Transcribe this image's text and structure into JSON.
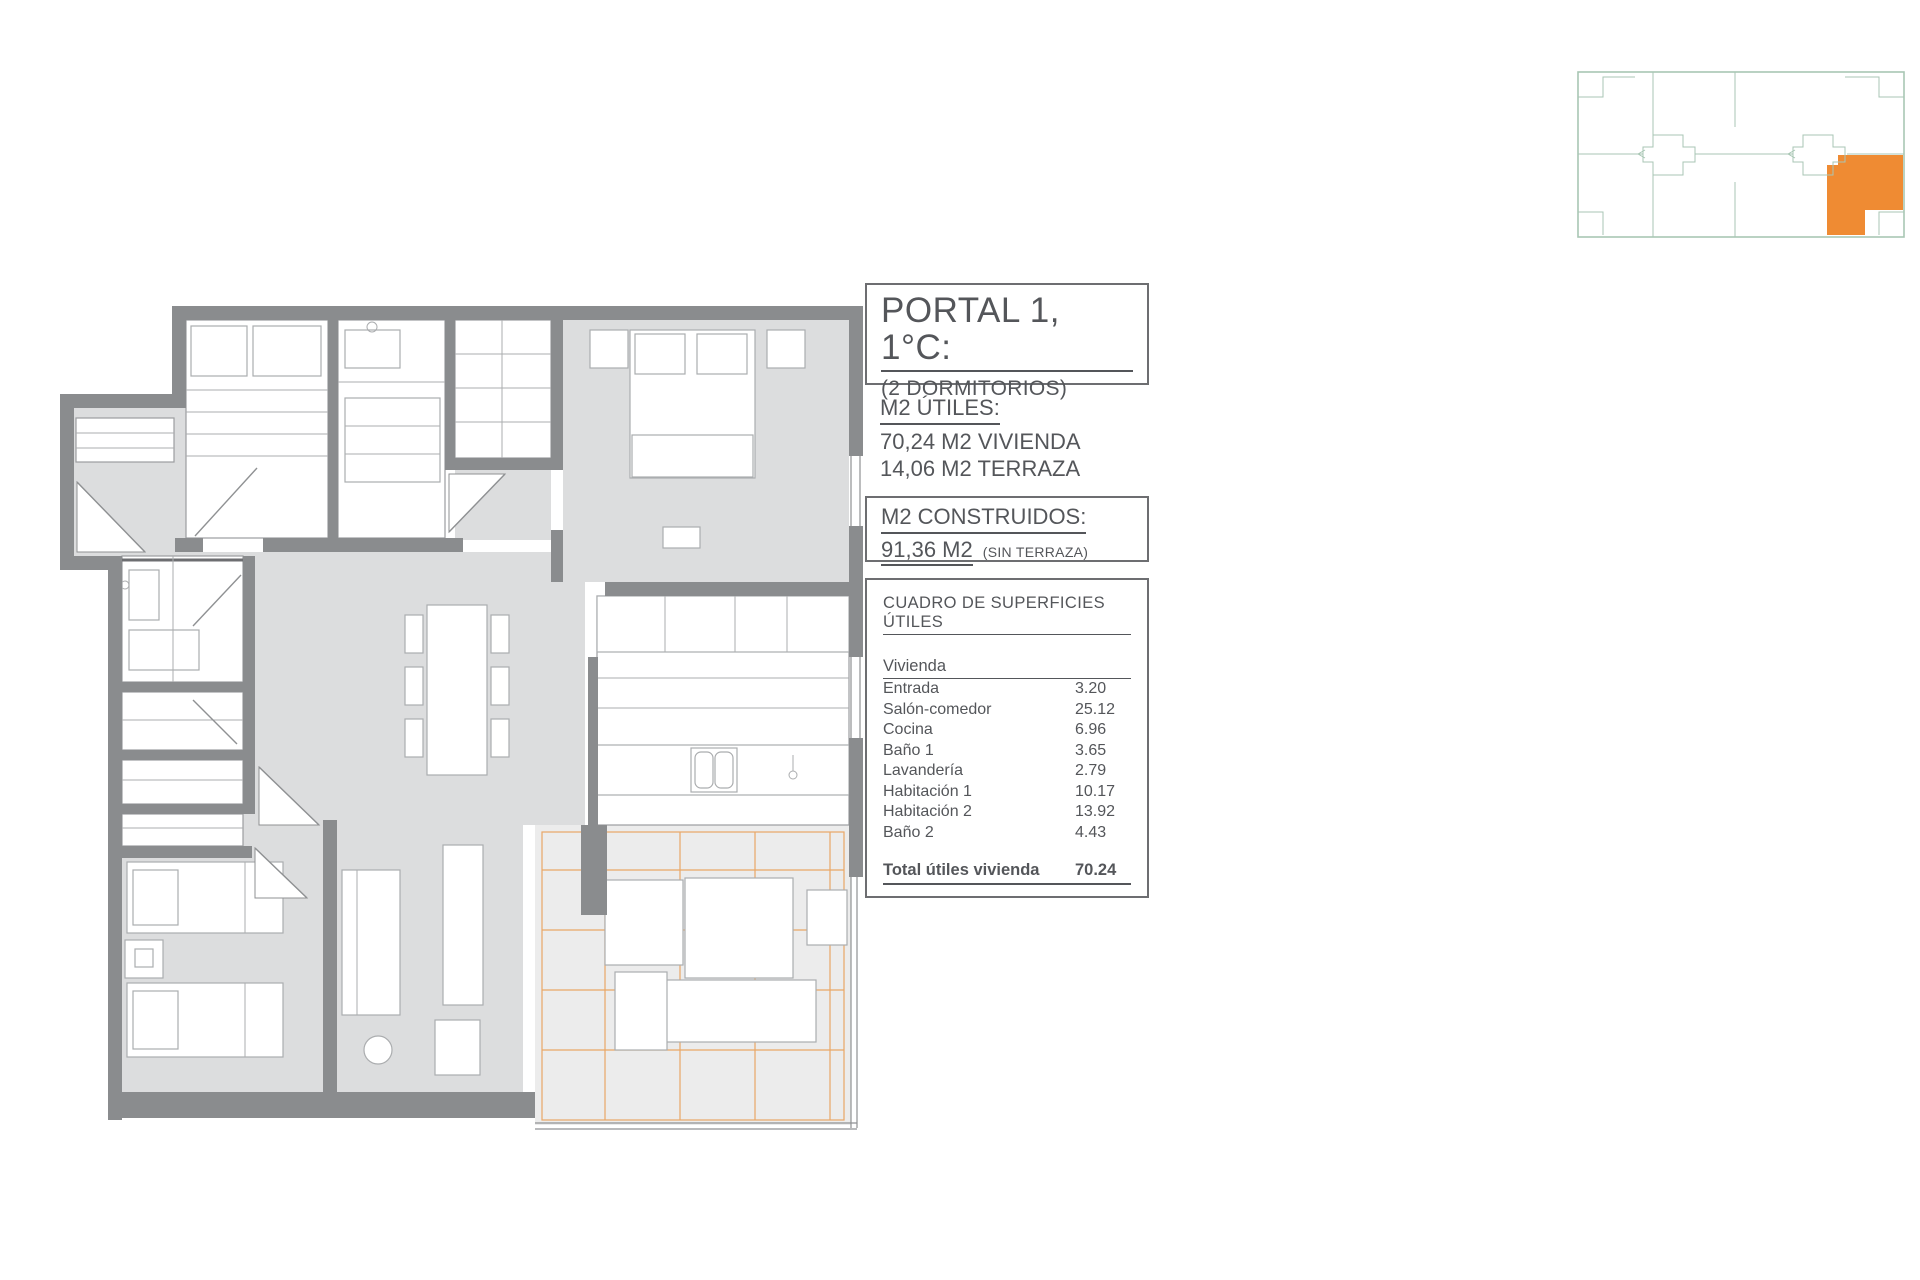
{
  "title_block": {
    "title": "PORTAL 1, 1°C:",
    "subtitle": "(2 DORMITORIOS)"
  },
  "m2_utiles": {
    "heading": "M2 ÚTILES:",
    "line1": "70,24 M2 VIVIENDA",
    "line2": "14,06 M2 TERRAZA"
  },
  "m2_construidos": {
    "heading": "M2 CONSTRUIDOS:",
    "value": "91,36 M2",
    "note": "(SIN TERRAZA)"
  },
  "surface_table": {
    "heading": "CUADRO DE SUPERFICIES ÚTILES",
    "group": "Vivienda",
    "rows": [
      {
        "label": "Entrada",
        "value": "3.20"
      },
      {
        "label": "Salón-comedor",
        "value": "25.12"
      },
      {
        "label": "Cocina",
        "value": "6.96"
      },
      {
        "label": "Baño 1",
        "value": "3.65"
      },
      {
        "label": "Lavandería",
        "value": "2.79"
      },
      {
        "label": "Habitación 1",
        "value": "10.17"
      },
      {
        "label": "Habitación 2",
        "value": "13.92"
      },
      {
        "label": "Baño 2",
        "value": "4.43"
      }
    ],
    "total_label": "Total útiles vivienda",
    "total_value": "70.24"
  },
  "colors": {
    "wall": "#8A8C8E",
    "floor": "#DCDDDE",
    "accent_orange": "#EF8B33",
    "terrace_grid": "#E9A766",
    "keyplan_green": "#A8C6B4",
    "text": "#54565A"
  }
}
